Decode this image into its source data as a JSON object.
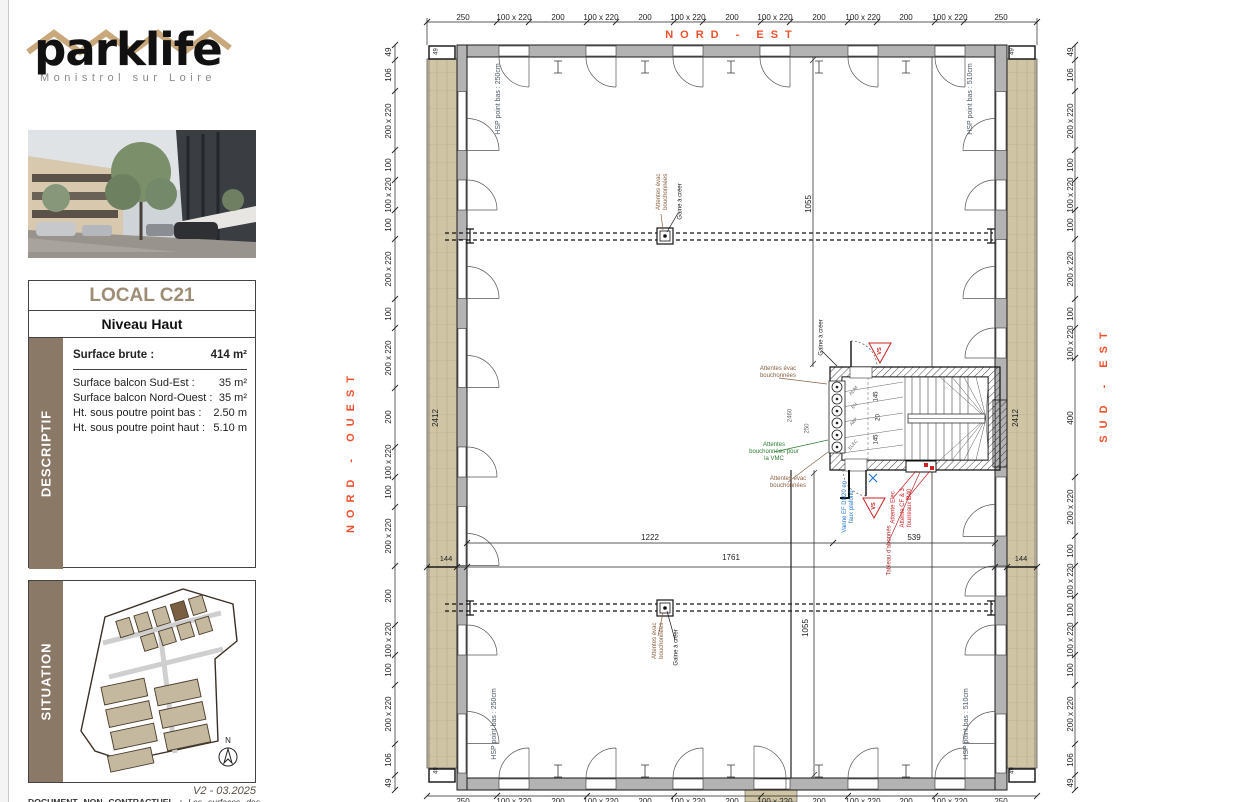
{
  "branding": {
    "logo": "parklife",
    "subtitle": "Monistrol sur Loire"
  },
  "info": {
    "title": "LOCAL C21",
    "level": "Niveau Haut",
    "descriptif_label": "DESCRIPTIF",
    "surface": {
      "label": "Surface brute :",
      "value": "414 m²"
    },
    "rows": [
      {
        "label": "Surface balcon Sud-Est :",
        "value": "35 m²"
      },
      {
        "label": "Surface balcon Nord-Ouest :",
        "value": "35 m²"
      },
      {
        "label": "Ht. sous poutre point bas :",
        "value": "2.50 m"
      },
      {
        "label": "Ht. sous poutre point haut :",
        "value": "5.10 m"
      }
    ]
  },
  "situation": {
    "label": "SITUATION",
    "compass": "N",
    "version": "V2 - 03.2025"
  },
  "disclaimer": {
    "prefix": "DOCUMENT NON CONTRACTUEL :",
    "text": "Les surfaces des espaces sont indicatives et pourront varier dans une limite de 5%."
  },
  "plan": {
    "directions": {
      "top": "NORD - EST",
      "left": "NORD - OUEST",
      "right": "SUD - EST"
    },
    "top_dims": [
      "250",
      "100 x 220",
      "200",
      "100 x 220",
      "200",
      "100 x 220",
      "200",
      "100 x 220",
      "200",
      "100 x 220",
      "200",
      "100 x 220",
      "250"
    ],
    "left_dims": [
      "49",
      "106",
      "200 x 220",
      "100",
      "100 x 220",
      "100",
      "200 x 220",
      "100",
      "200 x 220",
      "200",
      "100 x 220",
      "100",
      "200 x 220",
      "200",
      "100 x 220",
      "100",
      "200 x 220",
      "106",
      "49"
    ],
    "right_dims": [
      "49",
      "106",
      "200 x 220",
      "100",
      "100 x 220",
      "100",
      "200 x 220",
      "100",
      "100 x 220",
      "400",
      "200 x 220",
      "100",
      "100 x 220",
      "100",
      "100 x 220",
      "100",
      "200 x 220",
      "106",
      "49"
    ],
    "interior": {
      "d1222": "1222",
      "d539": "539",
      "d1761": "1761",
      "d144": "144",
      "d1055": "1055",
      "d2412": "2412",
      "d2460": "2460",
      "d250": "250",
      "d145": "145",
      "d20": "20",
      "corner": "49"
    },
    "hsp": {
      "bas250": "HSP point bas : 250cm",
      "bas510": "HSP point bas : 510cm"
    },
    "annotations": {
      "attentes_evac": "Attentes évac bouchonnées",
      "gaine": "Gaine à créer",
      "vmc": "Attentes bouchonnées pour la VMC",
      "vanne": "Vanne EF DN20 en faux plafond",
      "attente_elec": "Attente Elec",
      "attente_cf": "Attente CF & 3 fourreaux Ø40",
      "tableau": "Tableau d'abonnés",
      "vs": "VS",
      "shaft_labels": [
        "ALIM",
        "EU",
        "AEP",
        "ELEC"
      ]
    },
    "colors": {
      "direction": "#f0512d",
      "balcony": "#cfc4a4",
      "panel_brown": "#8b7968",
      "title_brown": "#9d8d74",
      "annotation_brown": "#8a6040",
      "blue": "#2277cc",
      "red": "#cc2222",
      "green": "#2e7d32",
      "hsp": "#4c5864"
    }
  }
}
